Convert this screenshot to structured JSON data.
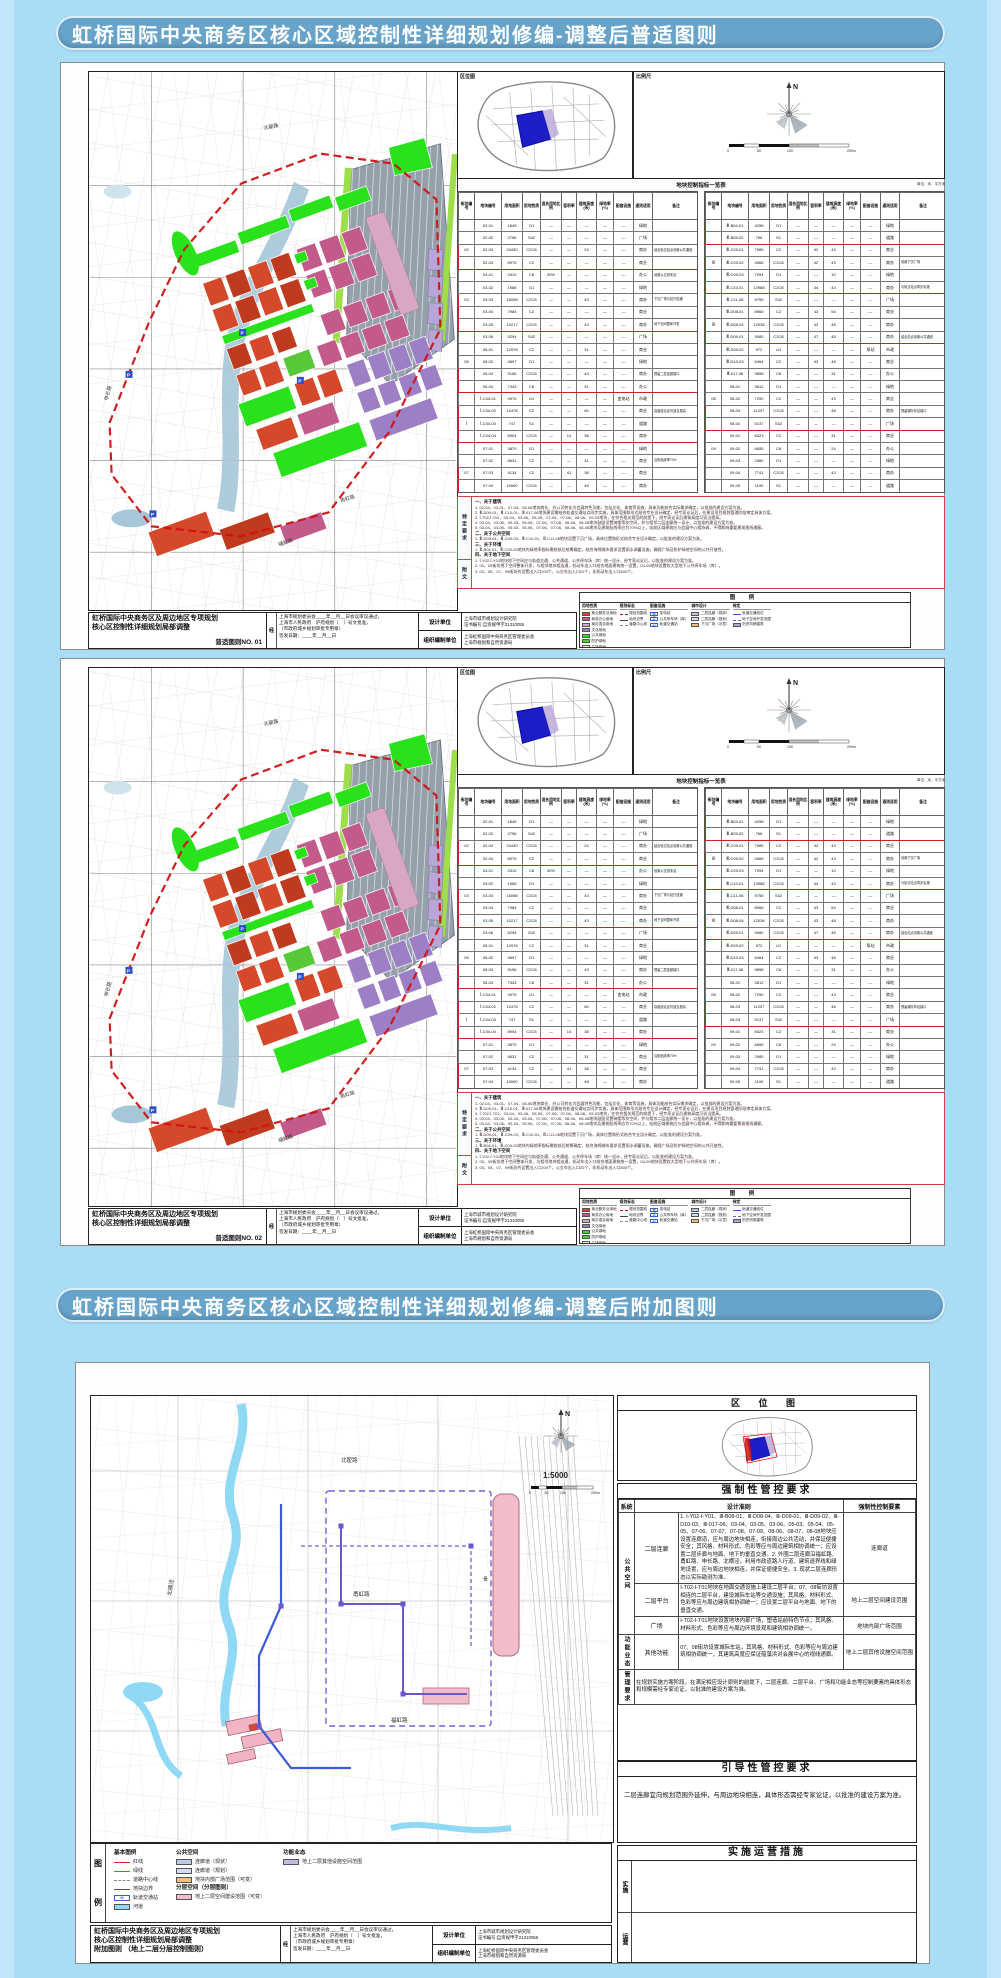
{
  "page": {
    "background": "#a9dcf5"
  },
  "headers": [
    {
      "text": "虹桥国际中央商务区核心区域控制性详细规划修编-调整后普适图则"
    },
    {
      "text": "虹桥国际中央商务区核心区域控制性详细规划修编-调整后附加图则"
    }
  ],
  "common": {
    "location_map_title": "区位图",
    "scale_box_title": "比例尺",
    "approval": {
      "prefix": "经",
      "lines": [
        "上海市规划委员会____年__月__日会议审议通过，",
        "上海市人民政府　沪府规划〔　〕号文批准，",
        "（市政府城乡规划审批专用章）",
        "签发日期：____年__月__日"
      ]
    },
    "design_unit": {
      "label": "设计单位",
      "name": "上海市城市规划设计研究院",
      "cert": "证书编号:自资规甲字21310055"
    },
    "org_unit": {
      "label": "组织编制单位",
      "names": [
        "上海虹桥国际中央商务区管理委员会",
        "上海市规划和自然资源局"
      ]
    }
  },
  "map_labels": {
    "north": "N",
    "scale3": "1:5000",
    "scale_ticks": [
      "0",
      "50",
      "100",
      "200m"
    ],
    "parking": "P",
    "metro": "M",
    "roads": [
      "北翟路",
      "申长路",
      "甬虹路",
      "福虹路",
      "申贵路",
      "北横泾"
    ]
  },
  "standard_sheets": [
    {
      "project_line1": "虹桥国际中央商务区及周边地区专项规划",
      "project_line2": "核心区控制性详细规划局部调整",
      "sheet_no": "普适图则NO. 01"
    },
    {
      "project_line1": "虹桥国际中央商务区及周边地区专项规划",
      "project_line2": "核心区控制性详细规划局部调整",
      "sheet_no": "普适图则NO. 02"
    }
  ],
  "indicator_table": {
    "title": "地块控制指标一览表",
    "unit_note": "单位：米、平方米",
    "columns": [
      "街坊编号",
      "地块编号",
      "用地面积",
      "用地性质",
      "混合用地比例",
      "容积率",
      "建筑高度(米)",
      "绿地率(%)",
      "配套设施",
      "通则适用",
      "备注"
    ],
    "halves": [
      {
        "rows": [
          [
            "",
            "02-01",
            "1845",
            "G1",
            "—",
            "—",
            "—",
            "—",
            "—",
            "绿地",
            ""
          ],
          [
            "",
            "02-02",
            "2756",
            "S42",
            "—",
            "—",
            "—",
            "—",
            "—",
            "广场",
            ""
          ],
          [
            "02",
            "02-03",
            "24430",
            "C2C8",
            "—",
            "—",
            "24",
            "—",
            "—",
            "商办",
            "结合轨交站点设置公共通道"
          ],
          [
            "",
            "02-04",
            "8975",
            "C2",
            "—",
            "—",
            "—",
            "—",
            "—",
            "商业",
            ""
          ],
          [
            "",
            "03-01",
            "4310",
            "C8",
            "30%",
            "—",
            "—",
            "—",
            "—",
            "办公",
            "设置公交首末站"
          ],
          [
            "",
            "03-02",
            "1968",
            "G1",
            "—",
            "—",
            "—",
            "—",
            "—",
            "绿地",
            ""
          ],
          [
            "03",
            "03-03",
            "16098",
            "C2C8",
            "—",
            "—",
            "43",
            "—",
            "—",
            "商办",
            "下沉广场与站厅连通"
          ],
          [
            "",
            "03-04",
            "7984",
            "C2",
            "—",
            "—",
            "—",
            "—",
            "—",
            "商业",
            ""
          ],
          [
            "",
            "03-05",
            "10217",
            "C2C8",
            "—",
            "—",
            "43",
            "—",
            "—",
            "商办",
            "地下空间整体开发"
          ],
          [
            "",
            "03-06",
            "5294",
            "S42",
            "—",
            "—",
            "—",
            "—",
            "—",
            "广场",
            ""
          ],
          [
            "",
            "05-01",
            "12978",
            "C2",
            "—",
            "—",
            "31",
            "—",
            "—",
            "商业",
            ""
          ],
          [
            "05",
            "05-02",
            "3897",
            "G1",
            "—",
            "—",
            "—",
            "—",
            "—",
            "绿地",
            ""
          ],
          [
            "",
            "05-03",
            "9156",
            "C2C8",
            "—",
            "—",
            "43",
            "—",
            "—",
            "商办",
            "预留二层连廊接口"
          ],
          [
            "",
            "05-04",
            "7343",
            "C8",
            "—",
            "—",
            "31",
            "—",
            "—",
            "办公",
            ""
          ],
          [
            "",
            "Ⅰ-C04-01",
            "4975",
            "U1",
            "—",
            "—",
            "—",
            "—",
            "变电站",
            "市政",
            ""
          ],
          [
            "",
            "Ⅰ-C04-02",
            "12478",
            "C2",
            "—",
            "—",
            "60",
            "—",
            "—",
            "商业",
            "高度经论证可适当提高"
          ],
          [
            "Ⅰ",
            "Ⅰ-C04-03",
            "747",
            "S1",
            "—",
            "—",
            "—",
            "—",
            "—",
            "道路",
            ""
          ],
          [
            "",
            "Ⅰ-C04-04",
            "8904",
            "C2C8",
            "—",
            "14",
            "38",
            "—",
            "—",
            "商办",
            ""
          ],
          [
            "",
            "07-01",
            "3870",
            "G1",
            "—",
            "—",
            "—",
            "—",
            "—",
            "绿地",
            ""
          ],
          [
            "",
            "07-02",
            "8631",
            "C2",
            "—",
            "—",
            "31",
            "—",
            "—",
            "商业",
            "沿街贴线率70%"
          ],
          [
            "07",
            "07-03",
            "4134",
            "C2",
            "—",
            "41",
            "38",
            "—",
            "—",
            "商业",
            ""
          ],
          [
            "",
            "07-04",
            "10060",
            "C2C8",
            "—",
            "—",
            "48",
            "—",
            "—",
            "商办",
            ""
          ]
        ],
        "highlight_groups": [
          [
            2,
            3
          ],
          [
            6,
            8
          ],
          [
            12,
            13
          ],
          [
            15,
            17
          ],
          [
            20,
            21
          ]
        ]
      },
      {
        "rows": [
          [
            "",
            "Ⅲ-B04-01",
            "4298",
            "G1",
            "—",
            "—",
            "—",
            "—",
            "—",
            "绿地",
            ""
          ],
          [
            "",
            "Ⅲ-B05-02",
            "766",
            "S1",
            "—",
            "—",
            "—",
            "—",
            "—",
            "道路",
            ""
          ],
          [
            "",
            "Ⅲ-C09-01",
            "7985",
            "C2",
            "—",
            "42",
            "43",
            "—",
            "—",
            "商业",
            ""
          ],
          [
            "Ⅲ",
            "Ⅲ-C09-02",
            "4566",
            "C2C8",
            "—",
            "42",
            "43",
            "—",
            "—",
            "商办",
            "设置下沉广场"
          ],
          [
            "",
            "Ⅲ-C09-03",
            "7094",
            "G1",
            "—",
            "—",
            "10",
            "—",
            "—",
            "绿地",
            ""
          ],
          [
            "",
            "Ⅲ-C10-01",
            "13988",
            "C2C8",
            "—",
            "44",
            "43",
            "—",
            "—",
            "商办",
            "与轨交站点同步实施"
          ],
          [
            "",
            "Ⅲ-C11-06",
            "9755",
            "S42",
            "—",
            "—",
            "—",
            "—",
            "—",
            "广场",
            ""
          ],
          [
            "",
            "Ⅲ-D08-01",
            "8966",
            "C2",
            "—",
            "43",
            "54",
            "—",
            "—",
            "商业",
            ""
          ],
          [
            "Ⅲ",
            "Ⅲ-D08-04",
            "12038",
            "C2C8",
            "—",
            "43",
            "48",
            "—",
            "—",
            "商办",
            ""
          ],
          [
            "",
            "Ⅲ-D09-01",
            "9080",
            "C2C8",
            "—",
            "47",
            "45",
            "—",
            "—",
            "商办",
            "结合站点设置公共通道"
          ],
          [
            "",
            "Ⅲ-D09-02",
            "972",
            "U1",
            "—",
            "—",
            "—",
            "—",
            "泵站",
            "市政",
            ""
          ],
          [
            "",
            "Ⅲ-D10-03",
            "6464",
            "C2",
            "—",
            "43",
            "48",
            "—",
            "—",
            "商业",
            ""
          ],
          [
            "",
            "Ⅲ-017-06",
            "9858",
            "C8",
            "—",
            "—",
            "31",
            "—",
            "—",
            "办公",
            ""
          ],
          [
            "",
            "08-01",
            "3812",
            "G1",
            "—",
            "—",
            "—",
            "—",
            "—",
            "绿地",
            ""
          ],
          [
            "08",
            "08-02",
            "7290",
            "C2",
            "—",
            "—",
            "43",
            "—",
            "—",
            "商业",
            ""
          ],
          [
            "",
            "08-03",
            "11207",
            "C2C8",
            "—",
            "—",
            "48",
            "—",
            "—",
            "商办",
            "预留城际车站接口"
          ],
          [
            "",
            "08-04",
            "5137",
            "S42",
            "—",
            "—",
            "—",
            "—",
            "—",
            "广场",
            ""
          ],
          [
            "",
            "09-01",
            "8423",
            "C2",
            "—",
            "—",
            "31",
            "—",
            "—",
            "商业",
            ""
          ],
          [
            "09",
            "09-02",
            "6655",
            "C8",
            "—",
            "—",
            "24",
            "—",
            "—",
            "办公",
            ""
          ],
          [
            "",
            "09-03",
            "2980",
            "G1",
            "—",
            "—",
            "—",
            "—",
            "—",
            "绿地",
            ""
          ],
          [
            "",
            "09-04",
            "7741",
            "C2C8",
            "—",
            "—",
            "43",
            "—",
            "—",
            "商办",
            ""
          ],
          [
            "",
            "09-05",
            "1190",
            "S1",
            "—",
            "—",
            "—",
            "—",
            "—",
            "道路",
            ""
          ]
        ],
        "highlight_groups": [
          [
            0,
            1
          ],
          [
            3,
            5
          ],
          [
            8,
            9
          ],
          [
            15,
            16
          ]
        ]
      }
    ]
  },
  "notes": {
    "side_labels": [
      "特定要求",
      "附文"
    ],
    "sections": [
      {
        "heading": "一、关于建筑",
        "lines": [
          "1. 02-04、03-01、07-04、08-06地块商业、办公可转化为会展特色功能，包括文化、体育等设施，具体功能结合实际需求确定，以批准的建设方案为准。",
          "2. Ⅲ-D09-01、Ⅲ-C10-01、Ⅲ-017-06地块建设需结合轨道交通站点同步实施，具体范围和形式结合专业设计确定，经专家论证后，在建设项目规划管理阶段审定具体方案。",
          "3. Ⅰ-T02-Ⅰ-T01、03-04、03-06、05-05、07-06、07-08、08-08、09-03地块，在符合相关规范的前提下，经专家论证后建筑高度可适当提高。",
          "4. 03-04、03-05、05-03、05-06、07-06、07-08、08-06、08-08地块鼓励设置骑楼等灰空间，并与相邻二层连廊统一设计，以批准的建设方案为准。",
          "5. 03-04、03-06、05-03、05-06、07-06、07-08、08-06、08-08地块及建筑贴线率应为70%以上，站前区域建筑应与会展中心相协调，不得影响重要景观视线通廊。"
        ]
      },
      {
        "heading": "二、关于公共空间",
        "lines": [
          "1. Ⅲ-D09-01、Ⅲ-C09-03、Ⅲ-C10-01、Ⅲ-C11-06地块设置下沉广场，具体位置和形式结合专业设计确定，以批准的建设方案为准。"
        ]
      },
      {
        "heading": "三、关于环境",
        "lines": [
          "1. Ⅲ-B04-01、Ⅲ-C09-03地块内绿地率指标需校核后统筹确定，结合海绵城市要求设置雨水调蓄设施，确保广场及防护绿地空间的公共开放性。"
        ]
      },
      {
        "heading": "四、关于地下空间",
        "lines": [
          "1. Ⅰ-Y02-Ⅰ-Y01地块地下空间应与轨道交通、公共通道、公共停车场（库）统一设计，经专家论证后，以批准的建设方案为准。",
          "2. 03、05街坊地下空间整体开发，与相邻地块相连通，机动车出入口结合地面建筑统一设置，04-09地块设置较大型地下公共停车场（库）。",
          "3. 03、05、07、09街坊共设置出入口200个，公交车出入口20个，非机动车出入口800个。"
        ]
      }
    ]
  },
  "legend_standard": {
    "title": "图 例",
    "groups": [
      {
        "name": "用地性质",
        "items": [
          {
            "label": "商业服务业用地",
            "type": "fill",
            "color": "#d6482a"
          },
          {
            "label": "商务办公用地",
            "type": "fill",
            "color": "#c25a8c"
          },
          {
            "label": "商办混合用地",
            "type": "fill",
            "color": "#d9a6c4"
          },
          {
            "label": "文化用地",
            "type": "fill",
            "color": "#9d7fc6"
          },
          {
            "label": "公共绿地",
            "type": "fill",
            "color": "#29e21c"
          },
          {
            "label": "防护绿地",
            "type": "fill",
            "color": "#57c838"
          },
          {
            "label": "广场用地",
            "type": "fill",
            "color": "#eeeeee"
          },
          {
            "label": "轨道交通用地",
            "type": "fill",
            "color": "#95a0ab"
          }
        ]
      },
      {
        "name": "规划标志",
        "items": [
          {
            "label": "规划范围线",
            "type": "dash",
            "color": "#cc1414"
          },
          {
            "label": "地块边界",
            "type": "line",
            "color": "#444444"
          },
          {
            "label": "道路中心线",
            "type": "dash",
            "color": "#888888"
          }
        ]
      },
      {
        "name": "配套设施",
        "items": [
          {
            "label": "变电站",
            "type": "icon",
            "color": "#3b5bd6",
            "glyph": "变"
          },
          {
            "label": "公共停车场（库）",
            "type": "icon",
            "color": "#3b5bd6",
            "glyph": "P"
          },
          {
            "label": "轨道交通站",
            "type": "icon",
            "color": "#3b5bd6",
            "glyph": "M"
          }
        ]
      },
      {
        "name": "城市设计",
        "items": [
          {
            "label": "二层连廊（现状）",
            "type": "fill",
            "color": "#b8cce8"
          },
          {
            "label": "二层连廊（规划）",
            "type": "fill",
            "color": "#d4dcf2"
          },
          {
            "label": "下沉广场（示意）",
            "type": "fill",
            "color": "#f5c07a"
          }
        ]
      },
      {
        "name": "待定",
        "items": [
          {
            "label": "轨道交通线位",
            "type": "line",
            "color": "#3b5bd6"
          },
          {
            "label": "地下空间开发范围",
            "type": "dash",
            "color": "#7a5fd0"
          },
          {
            "label": "历史风貌建筑",
            "type": "fill",
            "color": "#b9a6d9"
          }
        ]
      }
    ]
  },
  "addendum": {
    "project_line1": "虹桥国际中央商务区及周边地区专项规划",
    "project_line2": "核心区控制性详细规划局部调整",
    "sheet_no_line": "附加图则 （地上二层分层控制图则）",
    "location_title": "区 位 图",
    "mandatory": {
      "title": "强制性管控要求",
      "col_headers": [
        "系统",
        "设计准则",
        "强制性控制要素"
      ],
      "groups": [
        {
          "system": "公共空间",
          "rows": [
            {
              "name": "二层连廊",
              "text": "1. Ⅰ-Y02-Ⅰ-Y01、Ⅲ-B08-01、Ⅲ-D08-04、Ⅲ-D09-01、Ⅲ-D09-02、Ⅲ-D10-03、Ⅲ-017-06、03-04、03-05、03-06、05-03、05-04、05-05、07-06、07-07、07-08、07-09、08-06、08-07、08-08地块应设置连廊道，应与周边地块相连，衔接周边公共活动，并保证便捷安全；其风格、材料形式、色彩等应与周边建筑相协调统一；应设置二层步廊与地面、地下的垂直交通。2. 外围二层连廊沿福虹路、甬虹路、申长路、北横泾，利用市政道路人行道、建筑退界线和绿地设置，应与周边地块相连，并保证便捷安全。3. 现状二层连廊形态以实际勘测为准。",
              "element": "连廊道"
            },
            {
              "name": "二层平台",
              "text": "Ⅰ-T02-Ⅰ-T01地块在地面交通设施上建设二层平台；07、08街坊设置相连的二层平台，建设城际车站等交通设施；其风格、材料形式、色彩等应与周边建筑相协调统一；应设置二层平台与地面、地下的垂直交通。",
              "element": "地上二层空间建设范围"
            },
            {
              "name": "广场",
              "text": "Ⅰ-T02-Ⅰ-T01地块设置地块内部广场，塑造站前特色节点；其风格、材料形式、色彩等应与周边环境景观和建筑相协调统一。",
              "element": "地块内部广场范围"
            }
          ]
        },
        {
          "system": "功能业态",
          "rows": [
            {
              "name": "其他功能",
              "text": "07、08街坊设置城际车站，其风格、材料形式、色彩等应与周边建筑相协调统一，其建筑高度应保证蕴藻浜对会展中心的视线通廊。",
              "element": "地上二层其他设施空间范围"
            }
          ]
        }
      ],
      "management": {
        "system": "管理要求",
        "text": "在规划实施方案阶段，在满足相应设计原则的前提下，二层连廊、二层平台、广场和功能业态等控制要素的具体形态和规模需经专家论证，以批准的建设方案为准。"
      }
    },
    "guidance": {
      "title": "引导性管控要求",
      "text": "二层连廊宜向规划范围外延伸，与周边地块相连，具体形态需经专家论证，以批准的建设方案为准。"
    },
    "implementation": {
      "title": "实施运营措施",
      "row_labels": [
        "实施",
        "运营"
      ]
    },
    "legend": {
      "side_chars": [
        "图",
        "例"
      ],
      "groups": [
        {
          "name": "基本图例",
          "items": [
            {
              "label": "红线",
              "type": "line",
              "color": "#e02020"
            },
            {
              "label": "绿线",
              "type": "line",
              "color": "#22aa22"
            },
            {
              "label": "道路中心线",
              "type": "dash",
              "color": "#888888"
            },
            {
              "label": "地块边界",
              "type": "line",
              "color": "#555555"
            },
            {
              "label": "轨道交通站",
              "type": "icon",
              "color": "#3b5bd6",
              "glyph": "M"
            },
            {
              "label": "河道",
              "type": "fill",
              "color": "#8fd9f4"
            }
          ]
        },
        {
          "name": "公共空间",
          "items": [
            {
              "label": "连廊道（现状）",
              "type": "fill",
              "color": "#b8cce8"
            },
            {
              "label": "连廊道（规划）",
              "type": "fill",
              "color": "#d4dcf2"
            },
            {
              "label": "地块内部广场范围（可变）",
              "type": "fill",
              "color": "#f5c07a"
            }
          ]
        },
        {
          "name": "功能业态",
          "items": [
            {
              "label": "地上二层其他设施空间范围",
              "type": "fill",
              "color": "#c3b7e6"
            }
          ]
        },
        {
          "name": "分层空间（分层图则）",
          "items": [
            {
              "label": "地上二层空间建设范围（可变）",
              "type": "fill",
              "color": "#f3bcc9"
            }
          ]
        }
      ]
    }
  }
}
